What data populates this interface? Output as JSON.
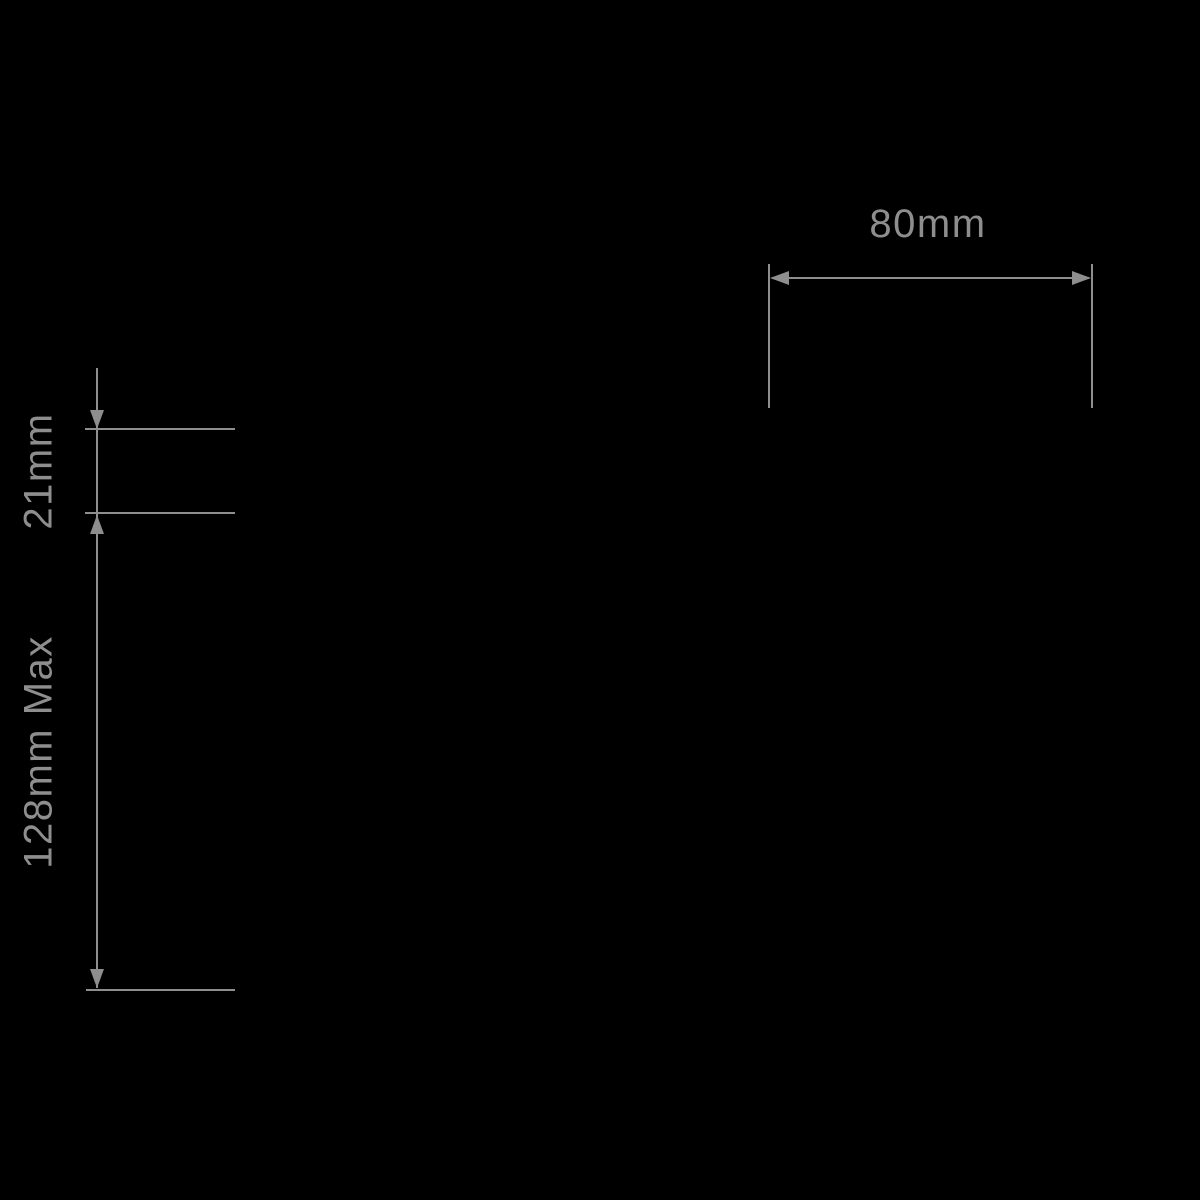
{
  "colors": {
    "background": "#000000",
    "line": "#8e8e8e",
    "text": "#8e8e8e"
  },
  "diagram": {
    "kind": "product-dimension-drawing",
    "dimensions": [
      {
        "id": "width",
        "label": "80mm",
        "orientation": "horizontal"
      },
      {
        "id": "thickness",
        "label": "21mm",
        "orientation": "vertical"
      },
      {
        "id": "height",
        "label": "128mm Max",
        "orientation": "vertical"
      }
    ]
  }
}
